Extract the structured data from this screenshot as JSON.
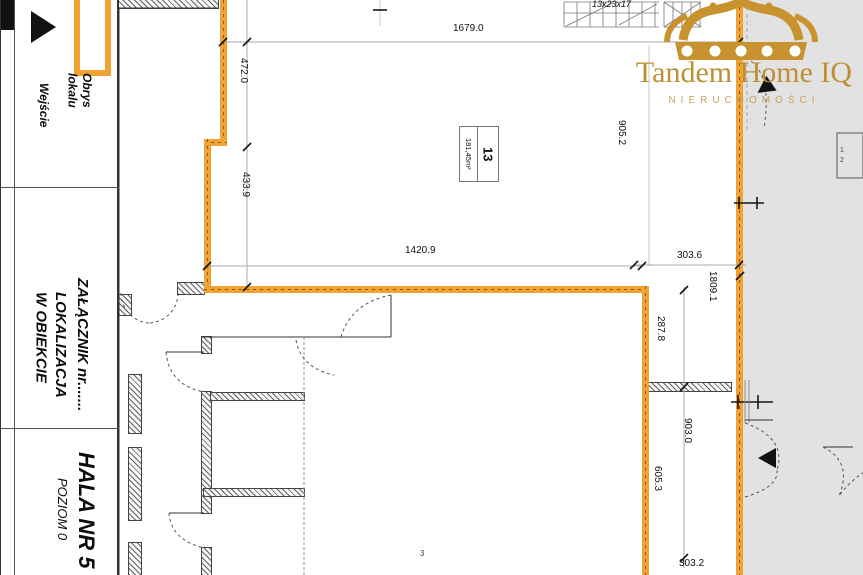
{
  "title_block": {
    "legend": {
      "entrance_label": "Wejście",
      "outline_label": "Obrys\nlokalu"
    },
    "attachment": "ZAŁĄCZNIK nr.......",
    "location": "LOKALIZACJA\nW OBIEKCIE",
    "hall": "HALA NR 5",
    "level": "POZIOM 0"
  },
  "logo": {
    "brand": "Tandem Home IQ",
    "subtitle": "NIERUCHOMOŚCI"
  },
  "unit": {
    "number": "13",
    "area": "181,45m²"
  },
  "plan": {
    "stair_note": "13x23x17",
    "room_note": "3",
    "door_leaf_1": "1",
    "door_leaf_2": "2",
    "dims": {
      "top": "1679.0",
      "left_upper": "472.0",
      "left_lower": "433.9",
      "inner_bottom": "1420.9",
      "right_inner": "905.2",
      "notch": "303.6",
      "strip_total": "1809.1",
      "strip_a": "287.8",
      "strip_b": "903.0",
      "strip_c": "605.3",
      "strip_d": "303.2"
    }
  },
  "colors": {
    "unit_outline": "#F0A232",
    "logo_gold": "#C8922F",
    "overlay_gray": "#E2E2E2"
  }
}
